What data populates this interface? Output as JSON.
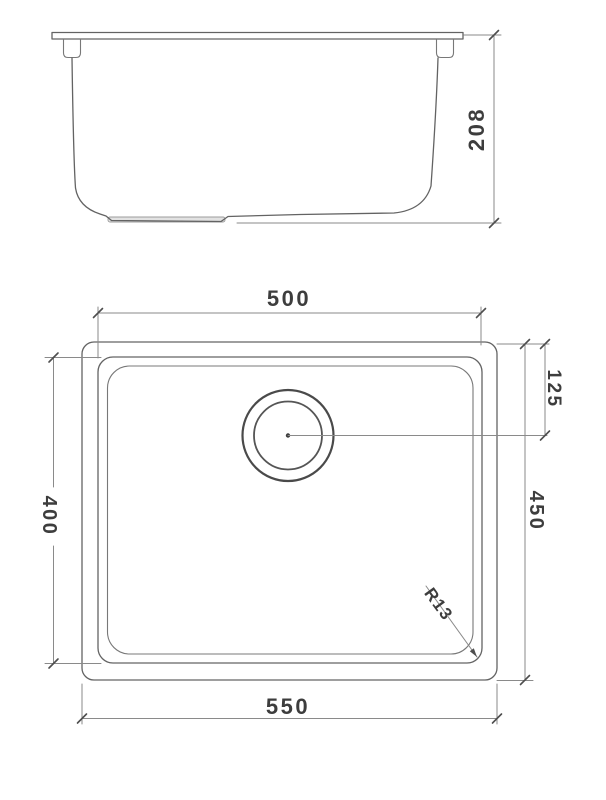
{
  "drawing": {
    "subject": "undermount-sink-technical-drawing",
    "colors": {
      "line": "#636363",
      "dimension_line": "#8a8a8a",
      "text": "#3d3d3d",
      "background": "#ffffff"
    },
    "side_view": {
      "depth_label": "208"
    },
    "plan_view": {
      "bowl_width_label": "500",
      "bowl_depth_label": "400",
      "outer_width_label": "550",
      "outer_depth_label": "450",
      "drain_offset_label": "125",
      "corner_radius_label": "R13"
    }
  }
}
